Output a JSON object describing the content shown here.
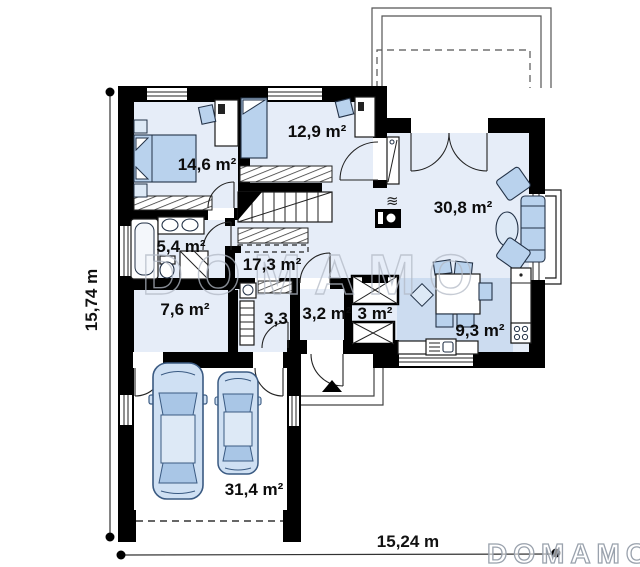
{
  "plan_title": "single-storey house floor plan",
  "watermark": {
    "center": "DOMAMO",
    "corner": "DOMAMO"
  },
  "dimensions": {
    "height_label": "15,74 m",
    "width_label": "15,24 m"
  },
  "rooms": {
    "bedroom1": "14,6 m²",
    "bedroom2": "12,9 m²",
    "living": "30,8 m²",
    "bathroom": "5,4 m²",
    "hallway": "17,3 m²",
    "utility": "7,6 m²",
    "wc": "3,3",
    "storage": "3,2 m²",
    "closet": "3 m²",
    "kitchen": "9,3 m²",
    "garage": "31,4 m²"
  },
  "colors": {
    "wall": "#000000",
    "floor_light": "#e6edf8",
    "floor_dark": "#ccdcf0",
    "furniture": "#b9d2ed",
    "car_body": "#cfe0f3",
    "car_glass": "#a9c6e6",
    "watermark": "#b3bac6"
  }
}
